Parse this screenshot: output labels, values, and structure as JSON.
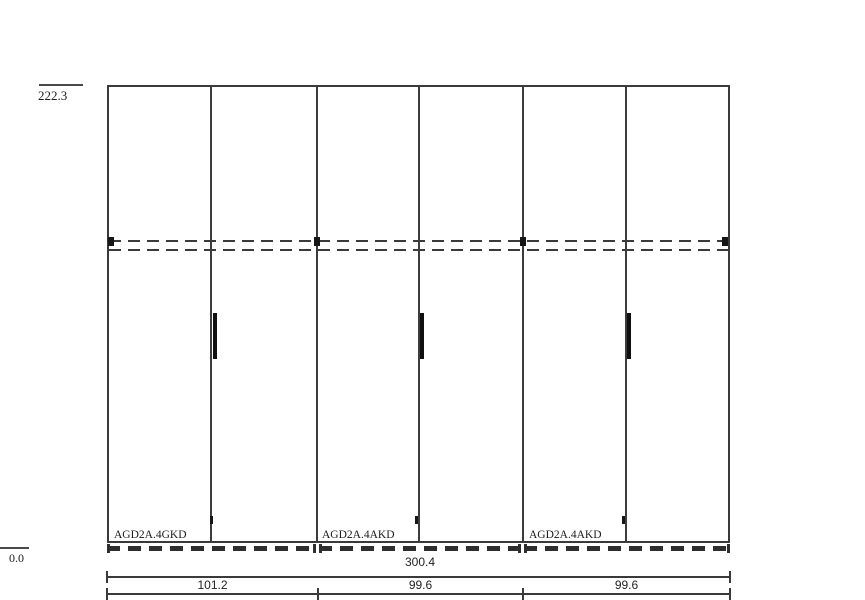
{
  "drawing": {
    "type": "wardrobe-front-elevation",
    "colors": {
      "background": "#ffffff",
      "line": "#3a3a3a",
      "accent_black": "#101010",
      "text": "#1c1c1c"
    },
    "elevation": {
      "top": "222.3",
      "bottom": "0.0"
    },
    "modules": [
      {
        "label": "AGD2A.4GKD",
        "width": "101.2"
      },
      {
        "label": "AGD2A.4AKD",
        "width": "99.6"
      },
      {
        "label": "AGD2A.4AKD",
        "width": "99.6"
      }
    ],
    "dimensions": {
      "total": "300.4",
      "segments": [
        "101.2",
        "99.6",
        "99.6"
      ]
    }
  }
}
